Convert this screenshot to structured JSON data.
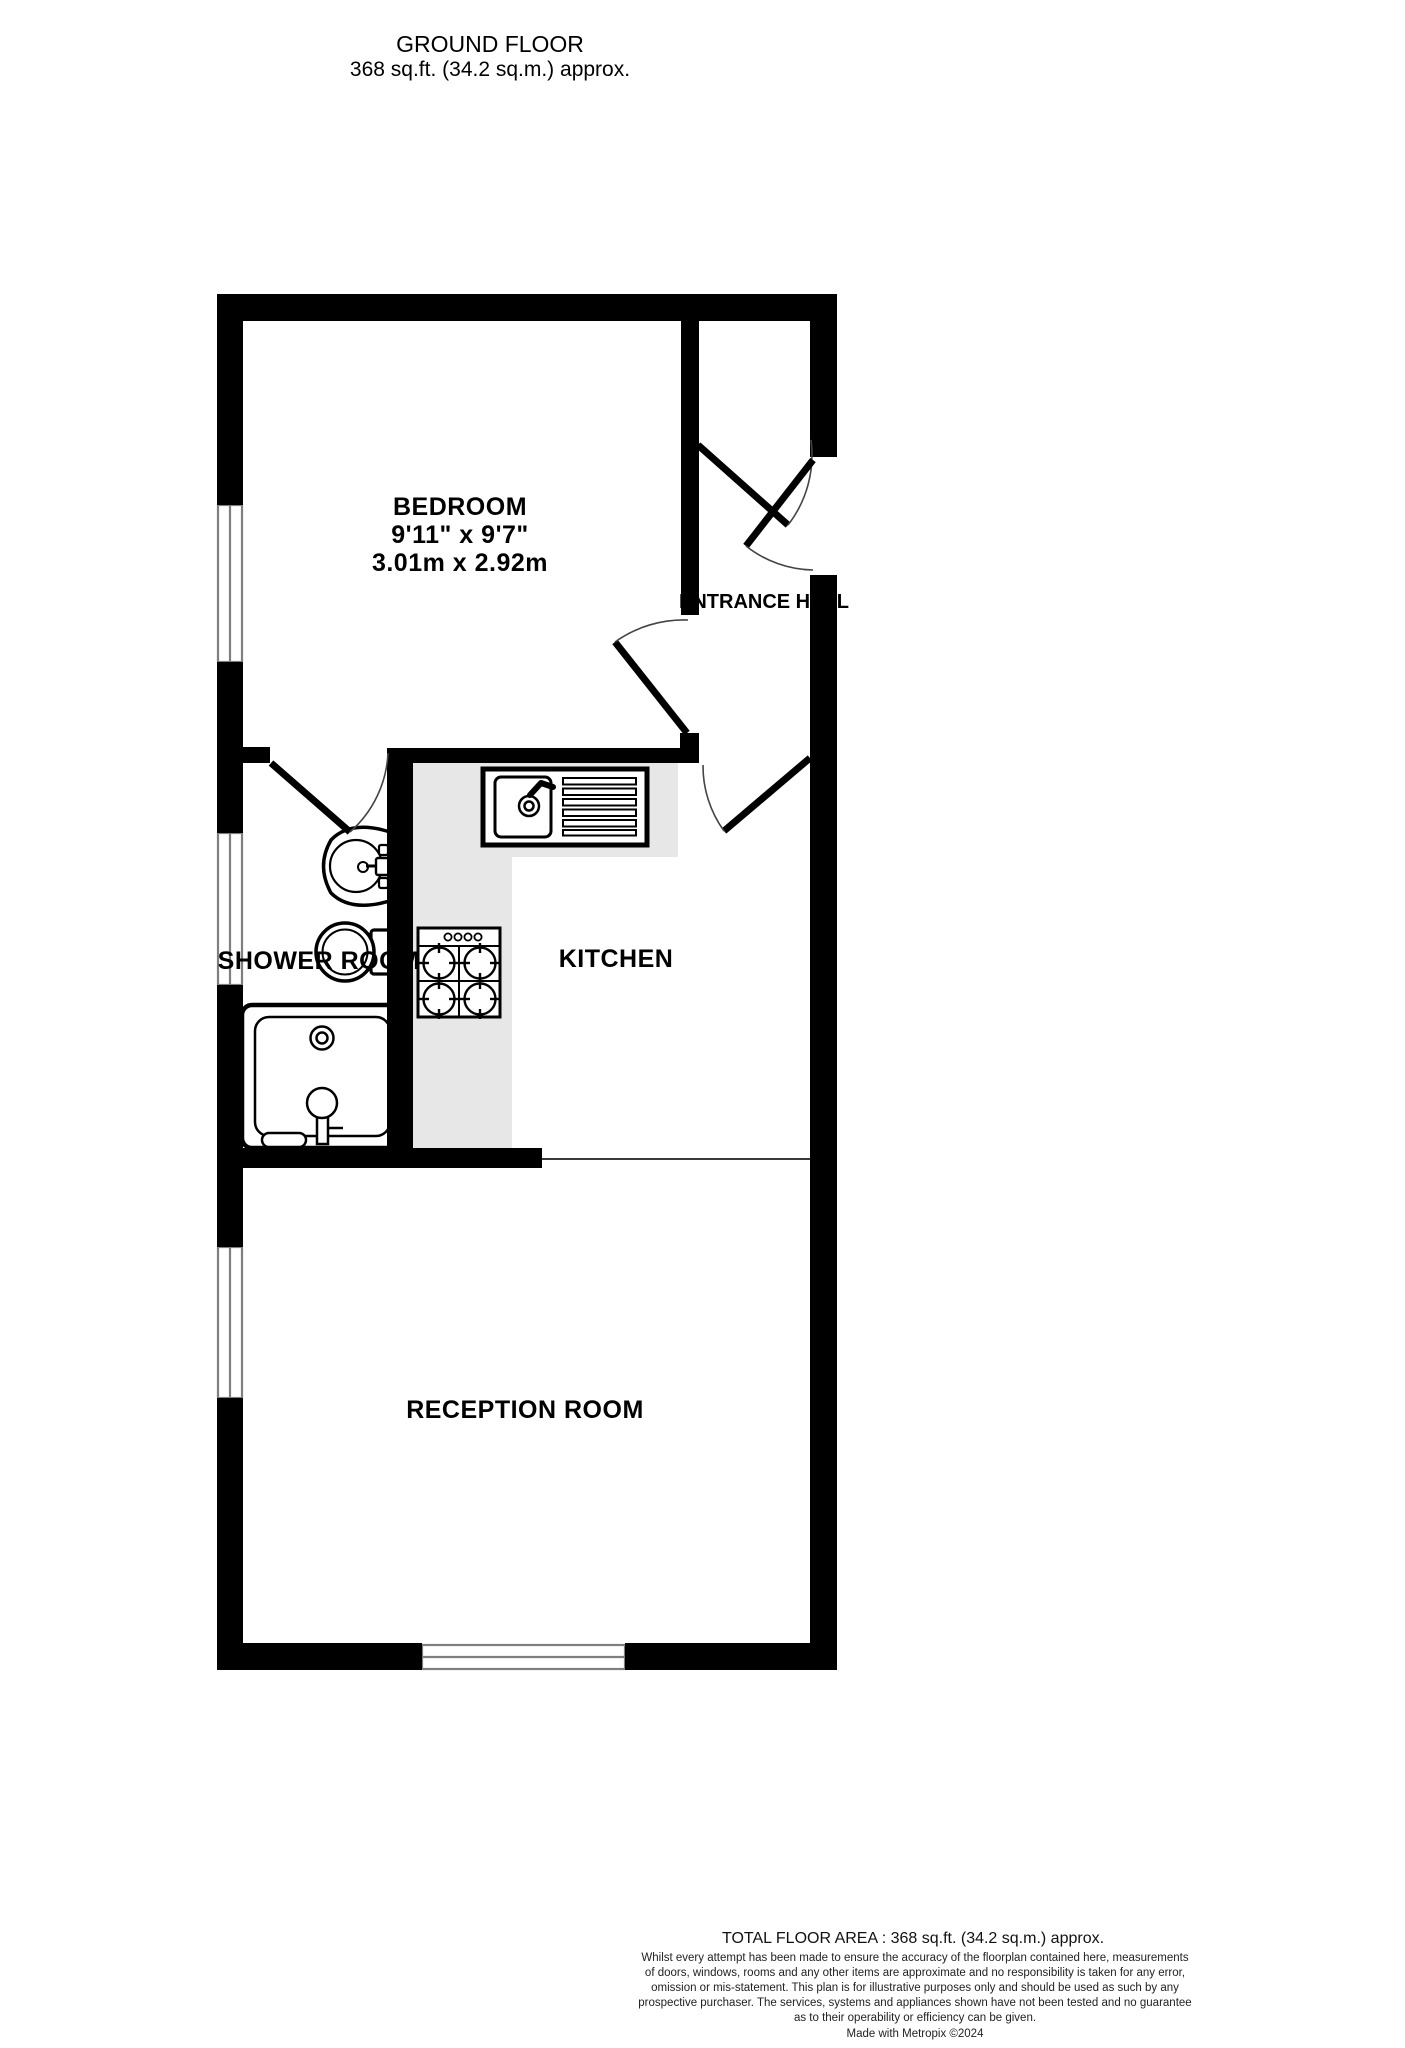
{
  "header": {
    "title": "GROUND FLOOR",
    "subtitle": "368 sq.ft. (34.2 sq.m.) approx."
  },
  "plan": {
    "rooms": [
      {
        "name": "BEDROOM",
        "dims_ft": "9'11\" x 9'7\"",
        "dims_m": "3.01m x 2.92m"
      },
      {
        "name": "ENTRANCE HALL"
      },
      {
        "name": "SHOWER ROOM"
      },
      {
        "name": "KITCHEN"
      },
      {
        "name": "RECEPTION ROOM"
      }
    ],
    "fixtures": [
      "kitchen-sink-with-drainer",
      "cooker-hob",
      "washbasin",
      "toilet",
      "shower-tray"
    ],
    "features": [
      "windows",
      "doors-with-swing-arcs",
      "kitchen-counter"
    ],
    "colors": {
      "wall": "#000000",
      "counter": "#e7e7e7",
      "window_line": "#7f7f7f",
      "door_arc": "#444444"
    }
  },
  "footer": {
    "total_area": "TOTAL FLOOR AREA : 368 sq.ft. (34.2 sq.m.) approx.",
    "disclaimer_lines": [
      "Whilst every attempt has been made to ensure the accuracy of the floorplan contained here, measurements",
      "of doors, windows, rooms and any other items are approximate and no responsibility is taken for any error,",
      "omission or mis-statement. This plan is for illustrative purposes only and should be used as such by any",
      "prospective purchaser. The services, systems and appliances shown have not been tested and no guarantee",
      "as to their operability or efficiency can be given."
    ],
    "credit": "Made with Metropix ©2024"
  }
}
